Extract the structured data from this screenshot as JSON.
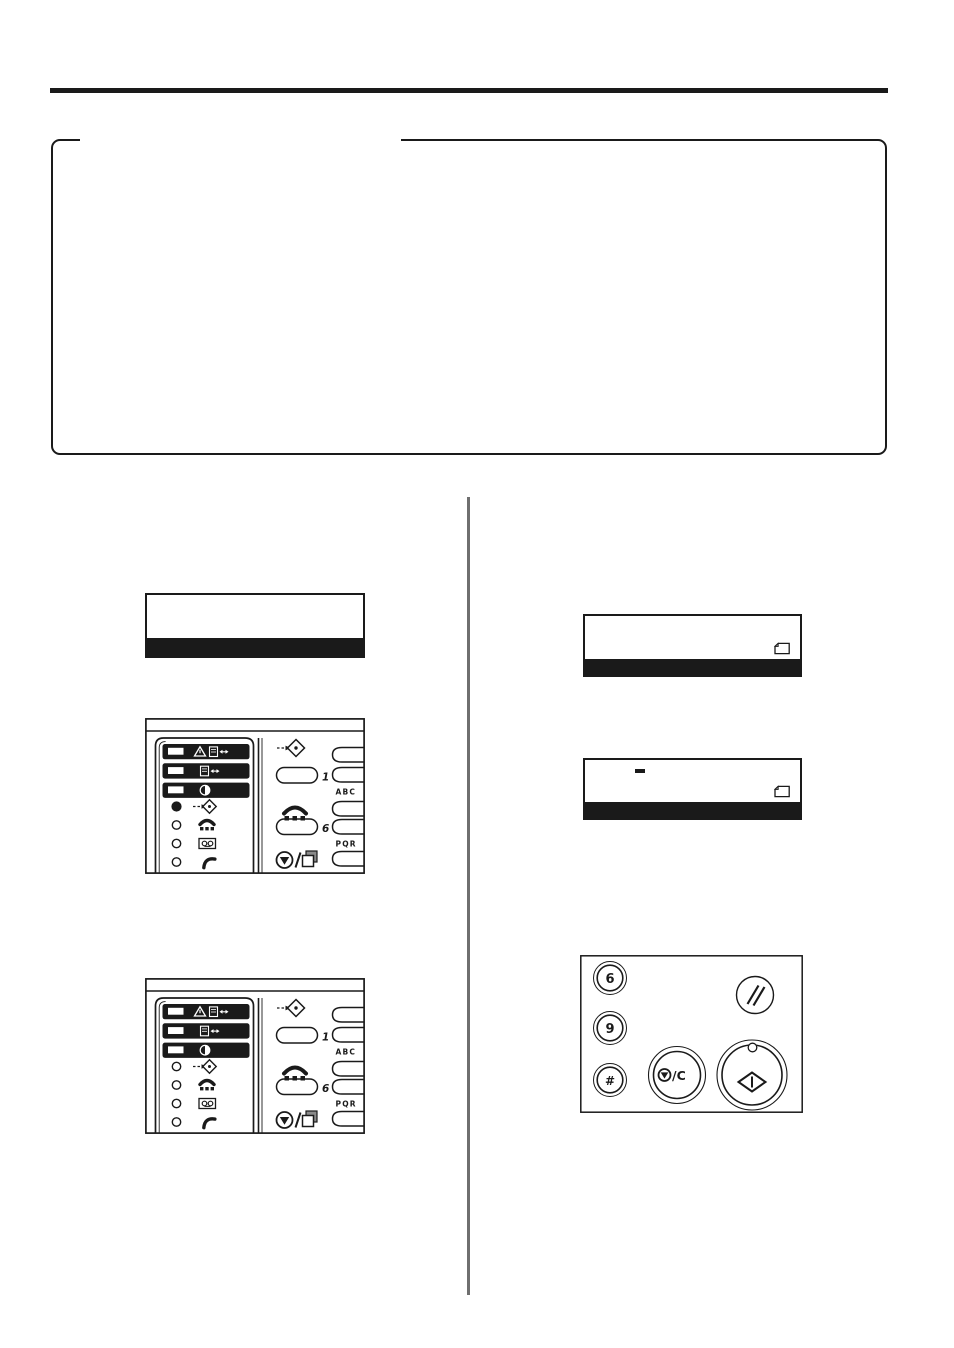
{
  "page": {
    "background": "#ffffff",
    "ink": "#1a1a1a",
    "divider_color": "#6f6f6f"
  },
  "note_box": {
    "style": "rounded rectangle with title gap in top border",
    "content": ""
  },
  "control_panel": {
    "one_touch_label_1": "1",
    "one_touch_label_6": "6",
    "letters_abc": "ABC",
    "letters_pqr": "PQR",
    "indicator_rows": [
      {
        "icon": "warning-and-document-size-icon",
        "lit": true
      },
      {
        "icon": "document-size-icon",
        "lit": true
      },
      {
        "icon": "contrast-icon",
        "lit": true
      },
      {
        "icon": "memory-transmit-icon",
        "led_panel_1": "on",
        "led_panel_2": "off"
      },
      {
        "icon": "on-hook-speaker-icon",
        "led": "off"
      },
      {
        "icon": "answering-machine-icon",
        "led": "off"
      },
      {
        "icon": "handset-icon",
        "led": "off"
      }
    ]
  },
  "keypad": {
    "digit_6": "6",
    "digit_9": "9",
    "hash_key": "#",
    "stop_clear_label": "/C",
    "keys": [
      "6",
      "9",
      "#",
      "reset",
      "stop-clear",
      "start"
    ]
  },
  "lcd_displays": {
    "left": {
      "lines": 2,
      "highlighted_line": 2,
      "text": ""
    },
    "right_1": {
      "lines": 2,
      "highlighted_line": 2,
      "text": "",
      "corner_icon": "document-icon"
    },
    "right_2": {
      "lines": 2,
      "highlighted_line": 2,
      "text": "",
      "cursor": "—",
      "corner_icon": "document-icon"
    }
  },
  "icons": {
    "warning-icon": "⚠",
    "document-size-icon": "▯↔",
    "contrast-icon": "◑",
    "memory-transmit-icon": "⇢◇",
    "on-hook-speaker-icon": "handset over dots",
    "answering-machine-icon": "cassette ⊙⊙",
    "handset-icon": "✆",
    "stop-copy-icon": "⊘/▢",
    "reset-icon": "//",
    "start-icon": "◇|",
    "document-icon": "🗋"
  }
}
